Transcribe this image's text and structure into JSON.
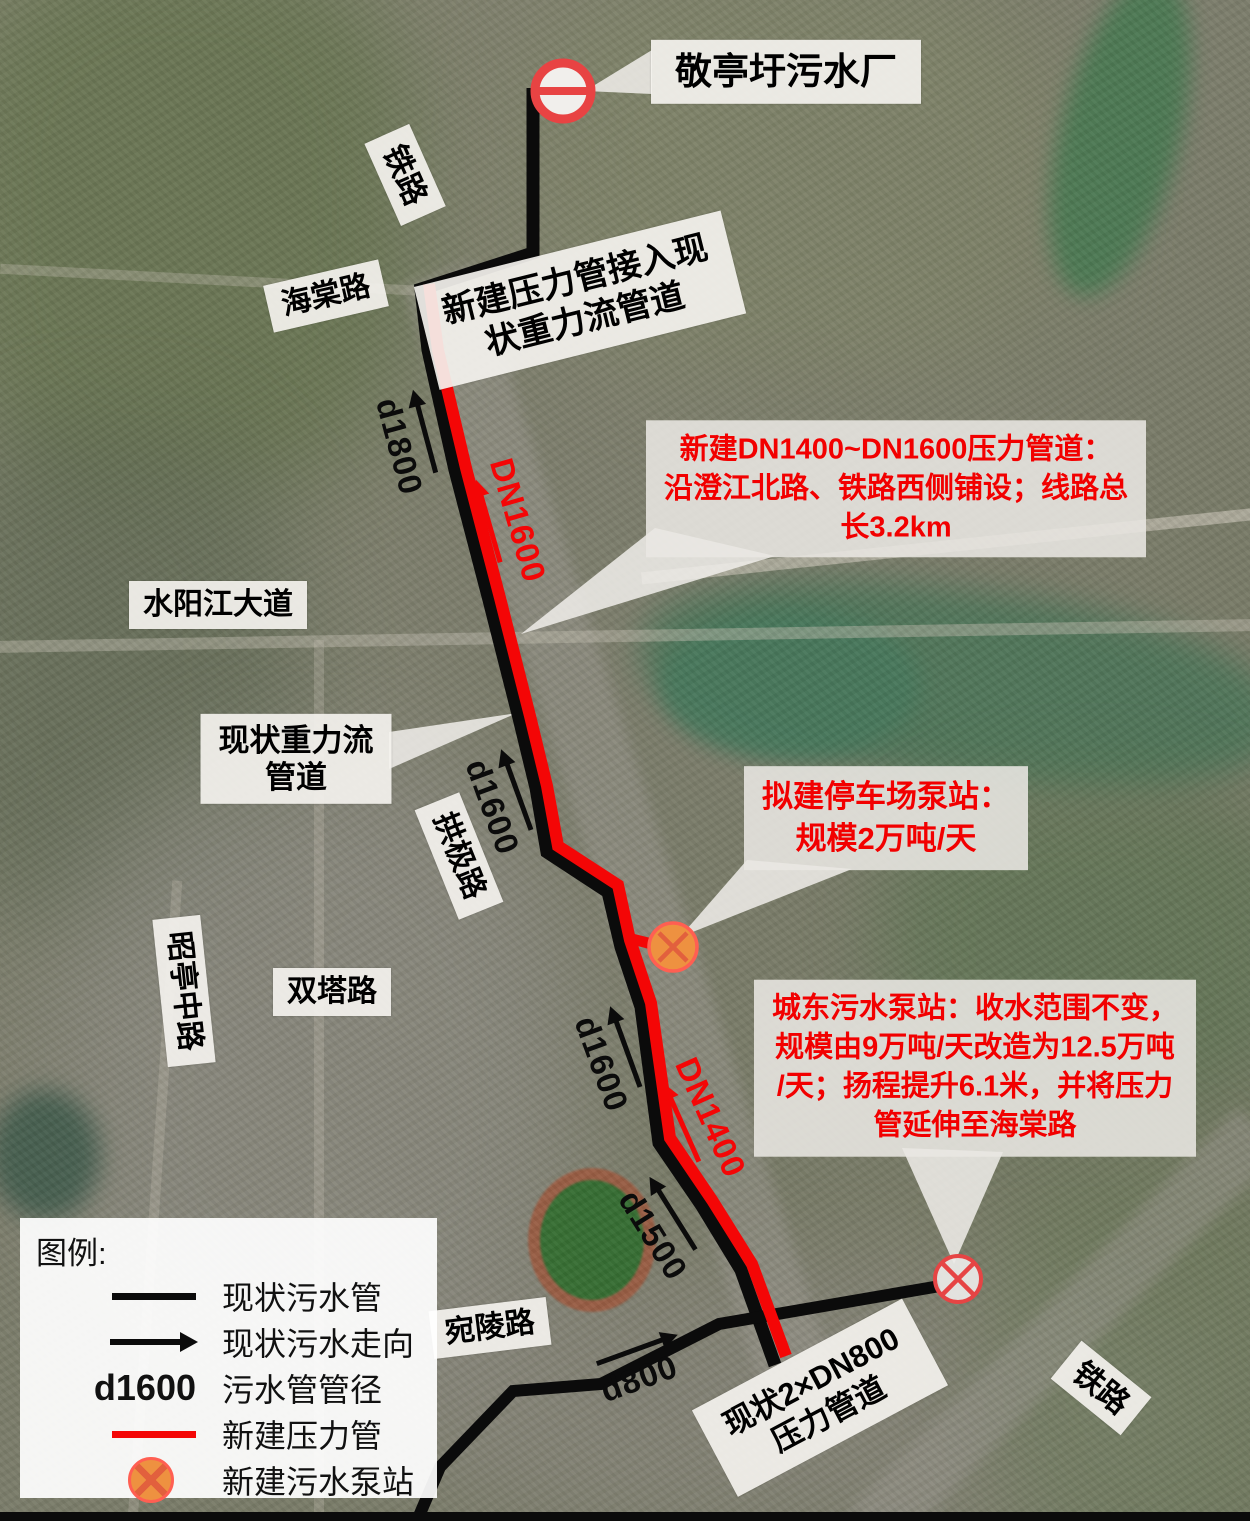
{
  "colors": {
    "existing_pipe": "#0b0b0b",
    "new_pipe": "#f40606",
    "callout_text": "#f20000",
    "pump_fill": "#ee9140",
    "pump_border": "#ff5f52",
    "pump_cross": "#e2603d",
    "station_symbol_red": "#e64444",
    "label_background": "#f4f2ee"
  },
  "plant": {
    "label": "敬亭圩污水厂"
  },
  "roads": {
    "railway_top": "铁路",
    "haitang": "海棠路",
    "shuiyangjiang": "水阳江大道",
    "gongji": "拱极路",
    "zhaoting": "昭亭中路",
    "shuangta": "双塔路",
    "wanling": "宛陵路",
    "railway_bottom": "铁路"
  },
  "callouts": {
    "connection": {
      "lines": [
        "新建压力管接入现",
        "状重力流管道"
      ]
    },
    "gravity": {
      "lines": [
        "现状重力流",
        "管道"
      ]
    },
    "dn_pipeline": {
      "lines": [
        "新建DN1400~DN1600压力管道：",
        "沿澄江北路、铁路西侧铺设；线路总",
        "长3.2km"
      ]
    },
    "parking_pump": {
      "lines": [
        "拟建停车场泵站：",
        "规模2万吨/天"
      ]
    },
    "chengdong_pump": {
      "lines": [
        "城东污水泵站：收水范围不变，",
        "规模由9万吨/天改造为12.5万吨",
        "/天；扬程提升6.1米，并将压力",
        "管延伸至海棠路"
      ]
    },
    "dn800": {
      "lines": [
        "现状2×DN800",
        "压力管道"
      ]
    }
  },
  "pipe_labels": {
    "d1800": "d1800",
    "dn1600": "DN1600",
    "d1600_mid": "d1600",
    "d1600_low": "d1600",
    "dn1400": "DN1400",
    "d1500": "d1500",
    "d800": "d800"
  },
  "legend": {
    "title": "图例:",
    "items": [
      {
        "symbol": "black-line",
        "label": "现状污水管"
      },
      {
        "symbol": "black-arrow",
        "label": "现状污水走向"
      },
      {
        "symbol": "d1600-text",
        "symbol_text": "d1600",
        "label": "污水管管径"
      },
      {
        "symbol": "red-line",
        "label": "新建压力管"
      },
      {
        "symbol": "orange-pump",
        "label": "新建污水泵站"
      }
    ]
  }
}
